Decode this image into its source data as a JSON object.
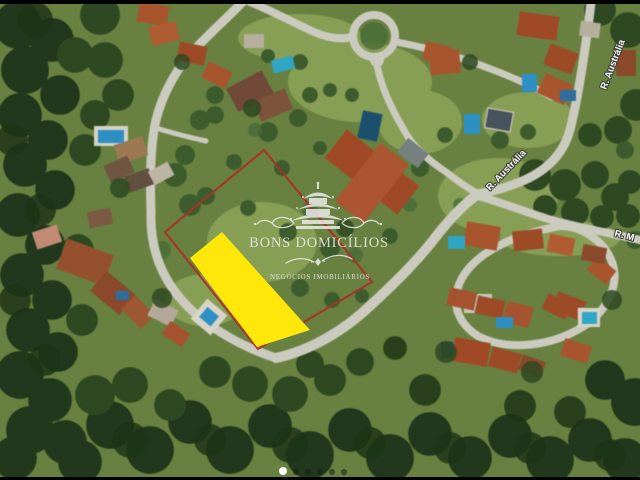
{
  "watermark": {
    "brand_name": "BONS DOMICÍLIOS",
    "tagline": "NEGÓCIOS IMOBILIÁRIOS"
  },
  "street_labels": {
    "australia_mid": "R. Austrália",
    "australia_top": "R. Austrália",
    "rua_m": "R. M"
  },
  "overlay": {
    "boundary_stroke": "#a93226",
    "lot_fill": "#ffe70a"
  },
  "carousel": {
    "total_dots": 6,
    "active_dot_index": 0,
    "active_color": "#ffffff",
    "inactive_color": "rgba(22,28,20,0.55)"
  }
}
